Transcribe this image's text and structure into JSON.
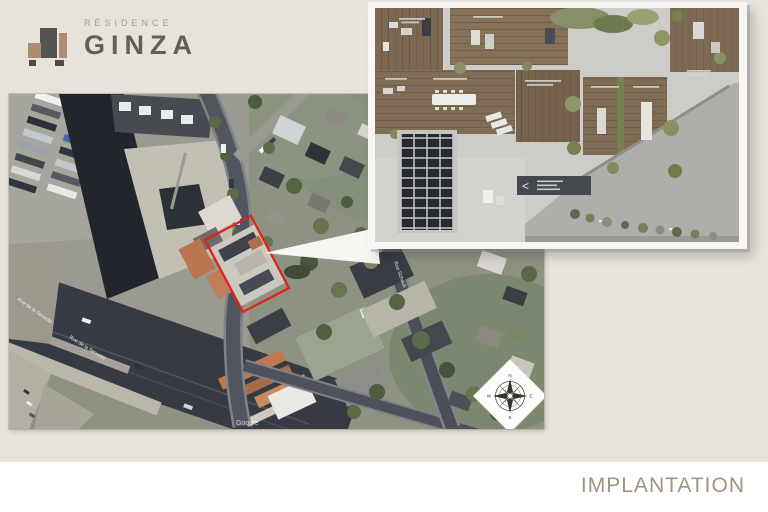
{
  "slide": {
    "footer": {
      "label": "IMPLANTATION"
    }
  },
  "logo": {
    "residence": "RÉSIDENCE",
    "name": "GINZA"
  },
  "map": {
    "streets": {
      "servette_a": "Rue de la Servette",
      "servette_b": "Rue de la Servette",
      "schaub": "Rue Schaub"
    },
    "watermark": "Google",
    "compass": {
      "n": "N",
      "e": "E",
      "s": "S",
      "w": "W"
    }
  },
  "roof_plan": {
    "sign_chevron": "<"
  },
  "colors": {
    "slide_background": "#e7e3da",
    "footer_text": "#a2927f",
    "parcel_outline": "#e02318",
    "brand_terracotta": "#b18a72",
    "brand_dark": "#575350",
    "logo_text": "#615f5a"
  }
}
